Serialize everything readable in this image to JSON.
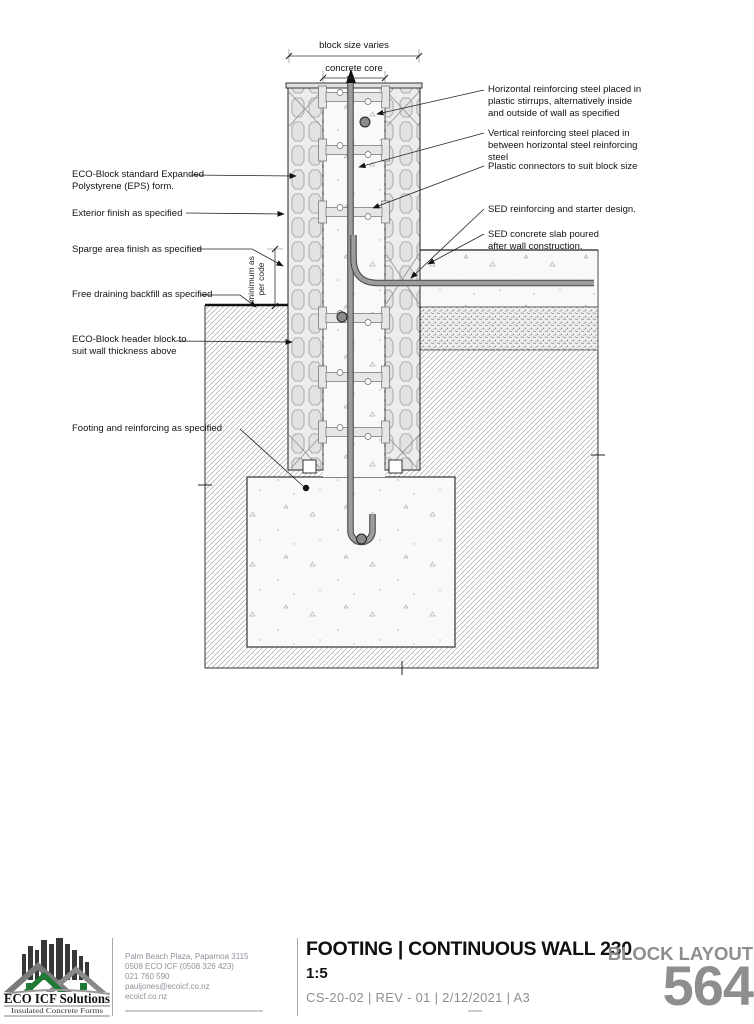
{
  "drawing": {
    "dims": {
      "block_size": "block size varies",
      "concrete_core": "concrete core",
      "min_code": "minimum as\nper code"
    },
    "annotations_left": [
      "ECO-Block standard Expanded\nPolystyrene (EPS) form.",
      "Exterior finish as specified",
      "Sparge area finish as specified",
      "Free draining backfill as specified",
      "ECO-Block header block to\nsuit wall thickness above",
      "Footing and reinforcing as specified"
    ],
    "annotations_right": [
      "Horizontal reinforcing steel placed in\nplastic stirrups, alternatively inside\nand outside of wall as specified",
      "Vertical reinforcing steel placed in\nbetween horizontal steel reinforcing\nsteel",
      "Plastic connectors to suit block size",
      "SED reinforcing and starter design.",
      "SED concrete slab poured\nafter wall construction."
    ]
  },
  "title_block": {
    "logo": {
      "name": "ECO ICF Solutions",
      "tagline": "Insulated Concrete Forms"
    },
    "contact_lines": [
      "Palm Beach Plaza, Papamoa 3115",
      "0508 ECO ICF (0508 326 423)",
      "021 760 590",
      "pauljones@ecoicf.co.nz",
      "ecoicf.co.nz"
    ],
    "title": "FOOTING | CONTINUOUS WALL 230",
    "scale": "1:5",
    "meta": "CS-20-02  |  REV - 01  |  2/12/2021  |  A3",
    "layout_label": "BLOCK LAYOUT",
    "sheet_number": "564"
  },
  "colors": {
    "accent_green": "#1e7a34",
    "title_gray": "#8e8e8e",
    "rebar_gray": "#9a9a9a"
  }
}
